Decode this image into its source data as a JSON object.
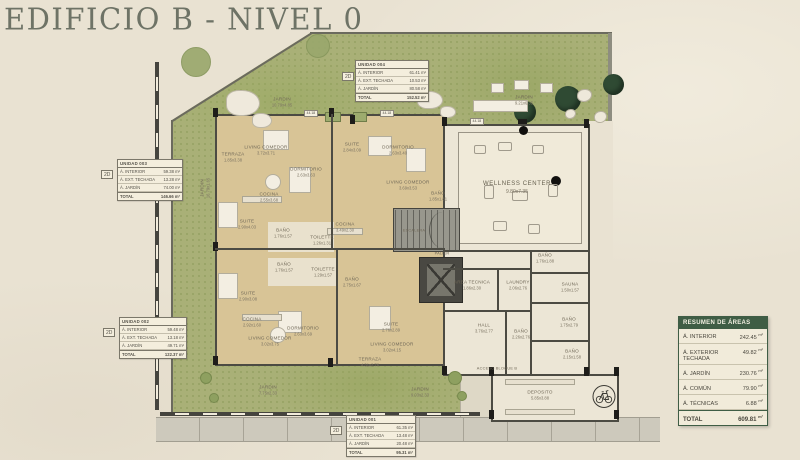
{
  "title": "EDIFICIO B - NIVEL 0",
  "colors": {
    "accent_green": "#3f5d45",
    "garden_green": "#a9b077",
    "room_tan": "#d8c496",
    "wall": "#4c4b43",
    "paper": "#e9e2d2"
  },
  "summary": {
    "header": "RESUMEN DE ÁREAS",
    "rows": [
      {
        "label": "Á. INTERIOR",
        "value": "242.45",
        "unit": "m²"
      },
      {
        "label": "Á. EXTERIOR TECHADA",
        "value": "49.82",
        "unit": "m²"
      },
      {
        "label": "Á. JARDÍN",
        "value": "230.76",
        "unit": "m²"
      },
      {
        "label": "Á. COMÚN",
        "value": "79.90",
        "unit": "m²"
      },
      {
        "label": "Á. TÉCNICAS",
        "value": "6.88",
        "unit": "m²"
      }
    ],
    "total": {
      "label": "TOTAL",
      "value": "609.81",
      "unit": "m²"
    }
  },
  "unit_tables": [
    {
      "badge": "2D",
      "title": "UNIDAD 001",
      "rows": [
        {
          "label": "Á. INTERIOR",
          "value": "61.35 m²"
        },
        {
          "label": "Á. EXT. TECHADA",
          "value": "13.48 m²"
        },
        {
          "label": "Á. JARDÍN",
          "value": "20.48 m²"
        }
      ],
      "total_label": "TOTAL",
      "total_value": "95.31 m²"
    },
    {
      "badge": "2D",
      "title": "UNIDAD 002",
      "rows": [
        {
          "label": "Á. INTERIOR",
          "value": "59.48 m²"
        },
        {
          "label": "Á. EXT. TECHADA",
          "value": "13.18 m²"
        },
        {
          "label": "Á. JARDÍN",
          "value": "49.71 m²"
        }
      ],
      "total_label": "TOTAL",
      "total_value": "122.37 m²"
    },
    {
      "badge": "2D",
      "title": "UNIDAD 003",
      "rows": [
        {
          "label": "Á. INTERIOR",
          "value": "59.38 m²"
        },
        {
          "label": "Á. EXT. TECHADA",
          "value": "13.28 m²"
        },
        {
          "label": "Á. JARDÍN",
          "value": "74.00 m²"
        }
      ],
      "total_label": "TOTAL",
      "total_value": "146.66 m²"
    },
    {
      "badge": "2D",
      "title": "UNIDAD 004",
      "rows": [
        {
          "label": "Á. INTERIOR",
          "value": "61.41 m²"
        },
        {
          "label": "Á. EXT. TECHADA",
          "value": "10.53 m²"
        },
        {
          "label": "Á. JARDÍN",
          "value": "80.58 m²"
        }
      ],
      "total_label": "TOTAL",
      "total_value": "152.52 m²"
    }
  ],
  "rooms": [
    {
      "x": 233,
      "y": 157,
      "label": "TERRAZA",
      "dims": "1.85x3.38"
    },
    {
      "x": 266,
      "y": 150,
      "label": "LIVING COMEDOR",
      "dims": "3.72x3.71"
    },
    {
      "x": 306,
      "y": 172,
      "label": "DORMITORIO",
      "dims": "2.63x3.63"
    },
    {
      "x": 269,
      "y": 197,
      "label": "COCINA",
      "dims": "2.55x3.68"
    },
    {
      "x": 247,
      "y": 224,
      "label": "SUITE",
      "dims": "2.90x4.03"
    },
    {
      "x": 283,
      "y": 233,
      "label": "BAÑO",
      "dims": "1.76x1.57"
    },
    {
      "x": 322,
      "y": 240,
      "label": "TOILETTE",
      "dims": "1.26x1.31"
    },
    {
      "x": 352,
      "y": 147,
      "label": "SUITE",
      "dims": "2.84x3.09"
    },
    {
      "x": 398,
      "y": 150,
      "label": "DORMITORIO",
      "dims": "2.63x3.40"
    },
    {
      "x": 408,
      "y": 185,
      "label": "LIVING COMEDOR",
      "dims": "3.69x3.53"
    },
    {
      "x": 345,
      "y": 227,
      "label": "COCINA",
      "dims": "3.49x2.30"
    },
    {
      "x": 438,
      "y": 196,
      "label": "BAÑO",
      "dims": "1.85x1.81"
    },
    {
      "x": 414,
      "y": 230,
      "label": "ESCALERA",
      "cls": "tiny"
    },
    {
      "x": 442,
      "y": 253,
      "label": "PALIER",
      "cls": "tiny"
    },
    {
      "x": 248,
      "y": 296,
      "label": "SUITE",
      "dims": "2.90x3.08"
    },
    {
      "x": 284,
      "y": 267,
      "label": "BAÑO",
      "dims": "1.76x1.57"
    },
    {
      "x": 323,
      "y": 272,
      "label": "TOILETTE",
      "dims": "1.29x1.57"
    },
    {
      "x": 352,
      "y": 282,
      "label": "BAÑO",
      "dims": "2.75x1.67"
    },
    {
      "x": 252,
      "y": 322,
      "label": "COCINA",
      "dims": "2.92x1.60"
    },
    {
      "x": 270,
      "y": 341,
      "label": "LIVING COMEDOR",
      "dims": "3.02x3.75"
    },
    {
      "x": 303,
      "y": 331,
      "label": "DORMITORIO",
      "dims": "2.63x3.69"
    },
    {
      "x": 391,
      "y": 327,
      "label": "SUITE",
      "dims": "2.76x2.89"
    },
    {
      "x": 392,
      "y": 347,
      "label": "LIVING COMEDOR",
      "dims": "3.02x4.15"
    },
    {
      "x": 370,
      "y": 362,
      "label": "TERRAZA",
      "dims": "4.31x2.76"
    },
    {
      "x": 517,
      "y": 188,
      "label": "WELLNESS CENTER",
      "dims": "9.80x7.35",
      "cls": "lg"
    },
    {
      "x": 545,
      "y": 258,
      "label": "BAÑO",
      "dims": "1.76x1.88"
    },
    {
      "x": 570,
      "y": 287,
      "label": "SAUNA",
      "dims": "1.50x1.57"
    },
    {
      "x": 569,
      "y": 322,
      "label": "BAÑO",
      "dims": "1.75x2.79"
    },
    {
      "x": 572,
      "y": 354,
      "label": "BAÑO",
      "dims": "2.15x1.58"
    },
    {
      "x": 472,
      "y": 285,
      "label": "AREA TECNICA",
      "dims": "1.86x2.30"
    },
    {
      "x": 518,
      "y": 285,
      "label": "LAUNDRY",
      "dims": "2.06x2.76"
    },
    {
      "x": 484,
      "y": 328,
      "label": "HALL",
      "dims": "3.76x2.77"
    },
    {
      "x": 521,
      "y": 334,
      "label": "BAÑO",
      "dims": "2.26x2.76"
    },
    {
      "x": 540,
      "y": 395,
      "label": "DEPOSITO",
      "dims": "5.85x3.88"
    },
    {
      "x": 497,
      "y": 368,
      "label": "ACCESO BLOQUE B",
      "cls": "tiny"
    },
    {
      "x": 282,
      "y": 102,
      "label": "JARDIN",
      "dims": "10.79x4.85"
    },
    {
      "x": 524,
      "y": 100,
      "label": "JARDIN",
      "dims": "9.21x6.35"
    },
    {
      "x": 205,
      "y": 188,
      "label": "JARDIN",
      "dims": "16.79x1.65",
      "cls": "vert"
    },
    {
      "x": 268,
      "y": 390,
      "label": "JARDIN",
      "dims": "7.75x2.33"
    },
    {
      "x": 420,
      "y": 392,
      "label": "JARDIN",
      "dims": "9.03x2.33"
    }
  ],
  "features": [
    {
      "cls": "tree-dark",
      "x": 514,
      "y": 101,
      "w": 22,
      "h": 22
    },
    {
      "cls": "tree-dark",
      "x": 555,
      "y": 86,
      "w": 26,
      "h": 26
    },
    {
      "cls": "tree-dark",
      "x": 603,
      "y": 74,
      "w": 21,
      "h": 21
    },
    {
      "cls": "tree-light",
      "x": 181,
      "y": 47,
      "w": 30,
      "h": 30
    },
    {
      "cls": "tree-light",
      "x": 306,
      "y": 34,
      "w": 24,
      "h": 24
    },
    {
      "cls": "rock",
      "x": 226,
      "y": 90,
      "w": 34,
      "h": 26
    },
    {
      "cls": "rock",
      "x": 252,
      "y": 113,
      "w": 20,
      "h": 15
    },
    {
      "cls": "rock",
      "x": 417,
      "y": 91,
      "w": 26,
      "h": 18
    },
    {
      "cls": "rock",
      "x": 440,
      "y": 106,
      "w": 16,
      "h": 12
    },
    {
      "cls": "furn",
      "x": 491,
      "y": 83,
      "w": 13,
      "h": 10
    },
    {
      "cls": "furn",
      "x": 514,
      "y": 80,
      "w": 15,
      "h": 10
    },
    {
      "cls": "furn",
      "x": 540,
      "y": 83,
      "w": 13,
      "h": 10
    },
    {
      "cls": "furn",
      "x": 473,
      "y": 100,
      "w": 55,
      "h": 12
    },
    {
      "cls": "blob",
      "x": 577,
      "y": 89,
      "w": 15,
      "h": 13
    },
    {
      "cls": "blob",
      "x": 594,
      "y": 111,
      "w": 13,
      "h": 12
    },
    {
      "cls": "blob",
      "x": 565,
      "y": 109,
      "w": 11,
      "h": 10
    },
    {
      "cls": "bush",
      "x": 200,
      "y": 372,
      "w": 12,
      "h": 12
    },
    {
      "cls": "bush",
      "x": 209,
      "y": 393,
      "w": 10,
      "h": 10
    },
    {
      "cls": "bush",
      "x": 448,
      "y": 371,
      "w": 14,
      "h": 14
    },
    {
      "cls": "bush",
      "x": 457,
      "y": 391,
      "w": 10,
      "h": 10
    },
    {
      "cls": "planter",
      "x": 325,
      "y": 112,
      "w": 16,
      "h": 10
    },
    {
      "cls": "planter",
      "x": 353,
      "y": 112,
      "w": 14,
      "h": 10
    },
    {
      "cls": "col",
      "x": 213,
      "y": 108,
      "w": 5,
      "h": 9
    },
    {
      "cls": "col",
      "x": 329,
      "y": 108,
      "w": 5,
      "h": 9
    },
    {
      "cls": "col",
      "x": 350,
      "y": 115,
      "w": 5,
      "h": 9
    },
    {
      "cls": "col",
      "x": 442,
      "y": 117,
      "w": 5,
      "h": 9
    },
    {
      "cls": "col",
      "x": 518,
      "y": 119,
      "w": 9,
      "h": 5
    },
    {
      "cls": "col",
      "x": 584,
      "y": 119,
      "w": 5,
      "h": 9
    },
    {
      "cls": "col",
      "x": 213,
      "y": 242,
      "w": 5,
      "h": 9
    },
    {
      "cls": "col",
      "x": 213,
      "y": 356,
      "w": 5,
      "h": 9
    },
    {
      "cls": "col",
      "x": 328,
      "y": 358,
      "w": 5,
      "h": 9
    },
    {
      "cls": "col",
      "x": 442,
      "y": 366,
      "w": 5,
      "h": 9
    },
    {
      "cls": "col",
      "x": 489,
      "y": 367,
      "w": 5,
      "h": 9
    },
    {
      "cls": "col",
      "x": 584,
      "y": 367,
      "w": 5,
      "h": 9
    },
    {
      "cls": "col",
      "x": 489,
      "y": 410,
      "w": 5,
      "h": 9
    },
    {
      "cls": "col",
      "x": 614,
      "y": 410,
      "w": 5,
      "h": 9
    },
    {
      "cls": "col",
      "x": 614,
      "y": 367,
      "w": 5,
      "h": 9
    },
    {
      "cls": "dot",
      "x": 519,
      "y": 126,
      "w": 9,
      "h": 9
    },
    {
      "cls": "dot",
      "x": 551,
      "y": 176,
      "w": 10,
      "h": 10
    },
    {
      "cls": "furn",
      "x": 263,
      "y": 130,
      "w": 26,
      "h": 20
    },
    {
      "cls": "furn",
      "x": 289,
      "y": 167,
      "w": 22,
      "h": 26
    },
    {
      "cls": "furn",
      "x": 218,
      "y": 202,
      "w": 20,
      "h": 26
    },
    {
      "cls": "furn",
      "x": 368,
      "y": 136,
      "w": 24,
      "h": 20
    },
    {
      "cls": "furn",
      "x": 406,
      "y": 148,
      "w": 20,
      "h": 24
    },
    {
      "cls": "furn",
      "x": 218,
      "y": 273,
      "w": 20,
      "h": 26
    },
    {
      "cls": "furn",
      "x": 278,
      "y": 311,
      "w": 24,
      "h": 22
    },
    {
      "cls": "furn",
      "x": 369,
      "y": 306,
      "w": 22,
      "h": 24
    },
    {
      "cls": "furn-round",
      "x": 265,
      "y": 174,
      "w": 16,
      "h": 16
    },
    {
      "cls": "furn-round",
      "x": 270,
      "y": 327,
      "w": 16,
      "h": 16
    },
    {
      "cls": "counter",
      "x": 242,
      "y": 196,
      "w": 40,
      "h": 7
    },
    {
      "cls": "counter",
      "x": 242,
      "y": 314,
      "w": 40,
      "h": 7
    },
    {
      "cls": "counter",
      "x": 327,
      "y": 228,
      "w": 36,
      "h": 7
    },
    {
      "cls": "counter",
      "x": 505,
      "y": 379,
      "w": 70,
      "h": 6
    },
    {
      "cls": "counter",
      "x": 505,
      "y": 409,
      "w": 70,
      "h": 6
    },
    {
      "cls": "equip",
      "x": 474,
      "y": 145,
      "w": 12,
      "h": 9
    },
    {
      "cls": "equip",
      "x": 498,
      "y": 142,
      "w": 14,
      "h": 9
    },
    {
      "cls": "equip",
      "x": 532,
      "y": 145,
      "w": 12,
      "h": 9
    },
    {
      "cls": "equip",
      "x": 484,
      "y": 185,
      "w": 10,
      "h": 14
    },
    {
      "cls": "equip",
      "x": 512,
      "y": 191,
      "w": 16,
      "h": 10
    },
    {
      "cls": "equip",
      "x": 548,
      "y": 184,
      "w": 10,
      "h": 13
    },
    {
      "cls": "equip",
      "x": 493,
      "y": 221,
      "w": 14,
      "h": 10
    },
    {
      "cls": "equip",
      "x": 528,
      "y": 224,
      "w": 12,
      "h": 10
    },
    {
      "cls": "dim",
      "x": 304,
      "y": 110,
      "text": "44.18"
    },
    {
      "cls": "dim",
      "x": 380,
      "y": 110,
      "text": "44.18"
    },
    {
      "cls": "dim",
      "x": 470,
      "y": 118,
      "text": "44.18"
    },
    {
      "cls": "wall",
      "x": 331,
      "y": 114,
      "w": 2,
      "h": 135
    },
    {
      "cls": "wall",
      "x": 215,
      "y": 248,
      "w": 230,
      "h": 2
    },
    {
      "cls": "wall",
      "x": 336,
      "y": 250,
      "w": 2,
      "h": 116
    },
    {
      "cls": "wall",
      "x": 443,
      "y": 250,
      "w": 147,
      "h": 2
    },
    {
      "cls": "wall",
      "x": 530,
      "y": 250,
      "w": 2,
      "h": 126
    },
    {
      "cls": "wall",
      "x": 530,
      "y": 272,
      "w": 60,
      "h": 1.5
    },
    {
      "cls": "wall",
      "x": 530,
      "y": 302,
      "w": 60,
      "h": 1.5
    },
    {
      "cls": "wall",
      "x": 530,
      "y": 340,
      "w": 60,
      "h": 1.5
    },
    {
      "cls": "wall",
      "x": 443,
      "y": 268,
      "w": 87,
      "h": 1.5
    },
    {
      "cls": "wall",
      "x": 497,
      "y": 268,
      "w": 1.5,
      "h": 43
    },
    {
      "cls": "wall",
      "x": 443,
      "y": 310,
      "w": 87,
      "h": 1.5
    },
    {
      "cls": "wall",
      "x": 505,
      "y": 310,
      "w": 1.5,
      "h": 66
    }
  ]
}
